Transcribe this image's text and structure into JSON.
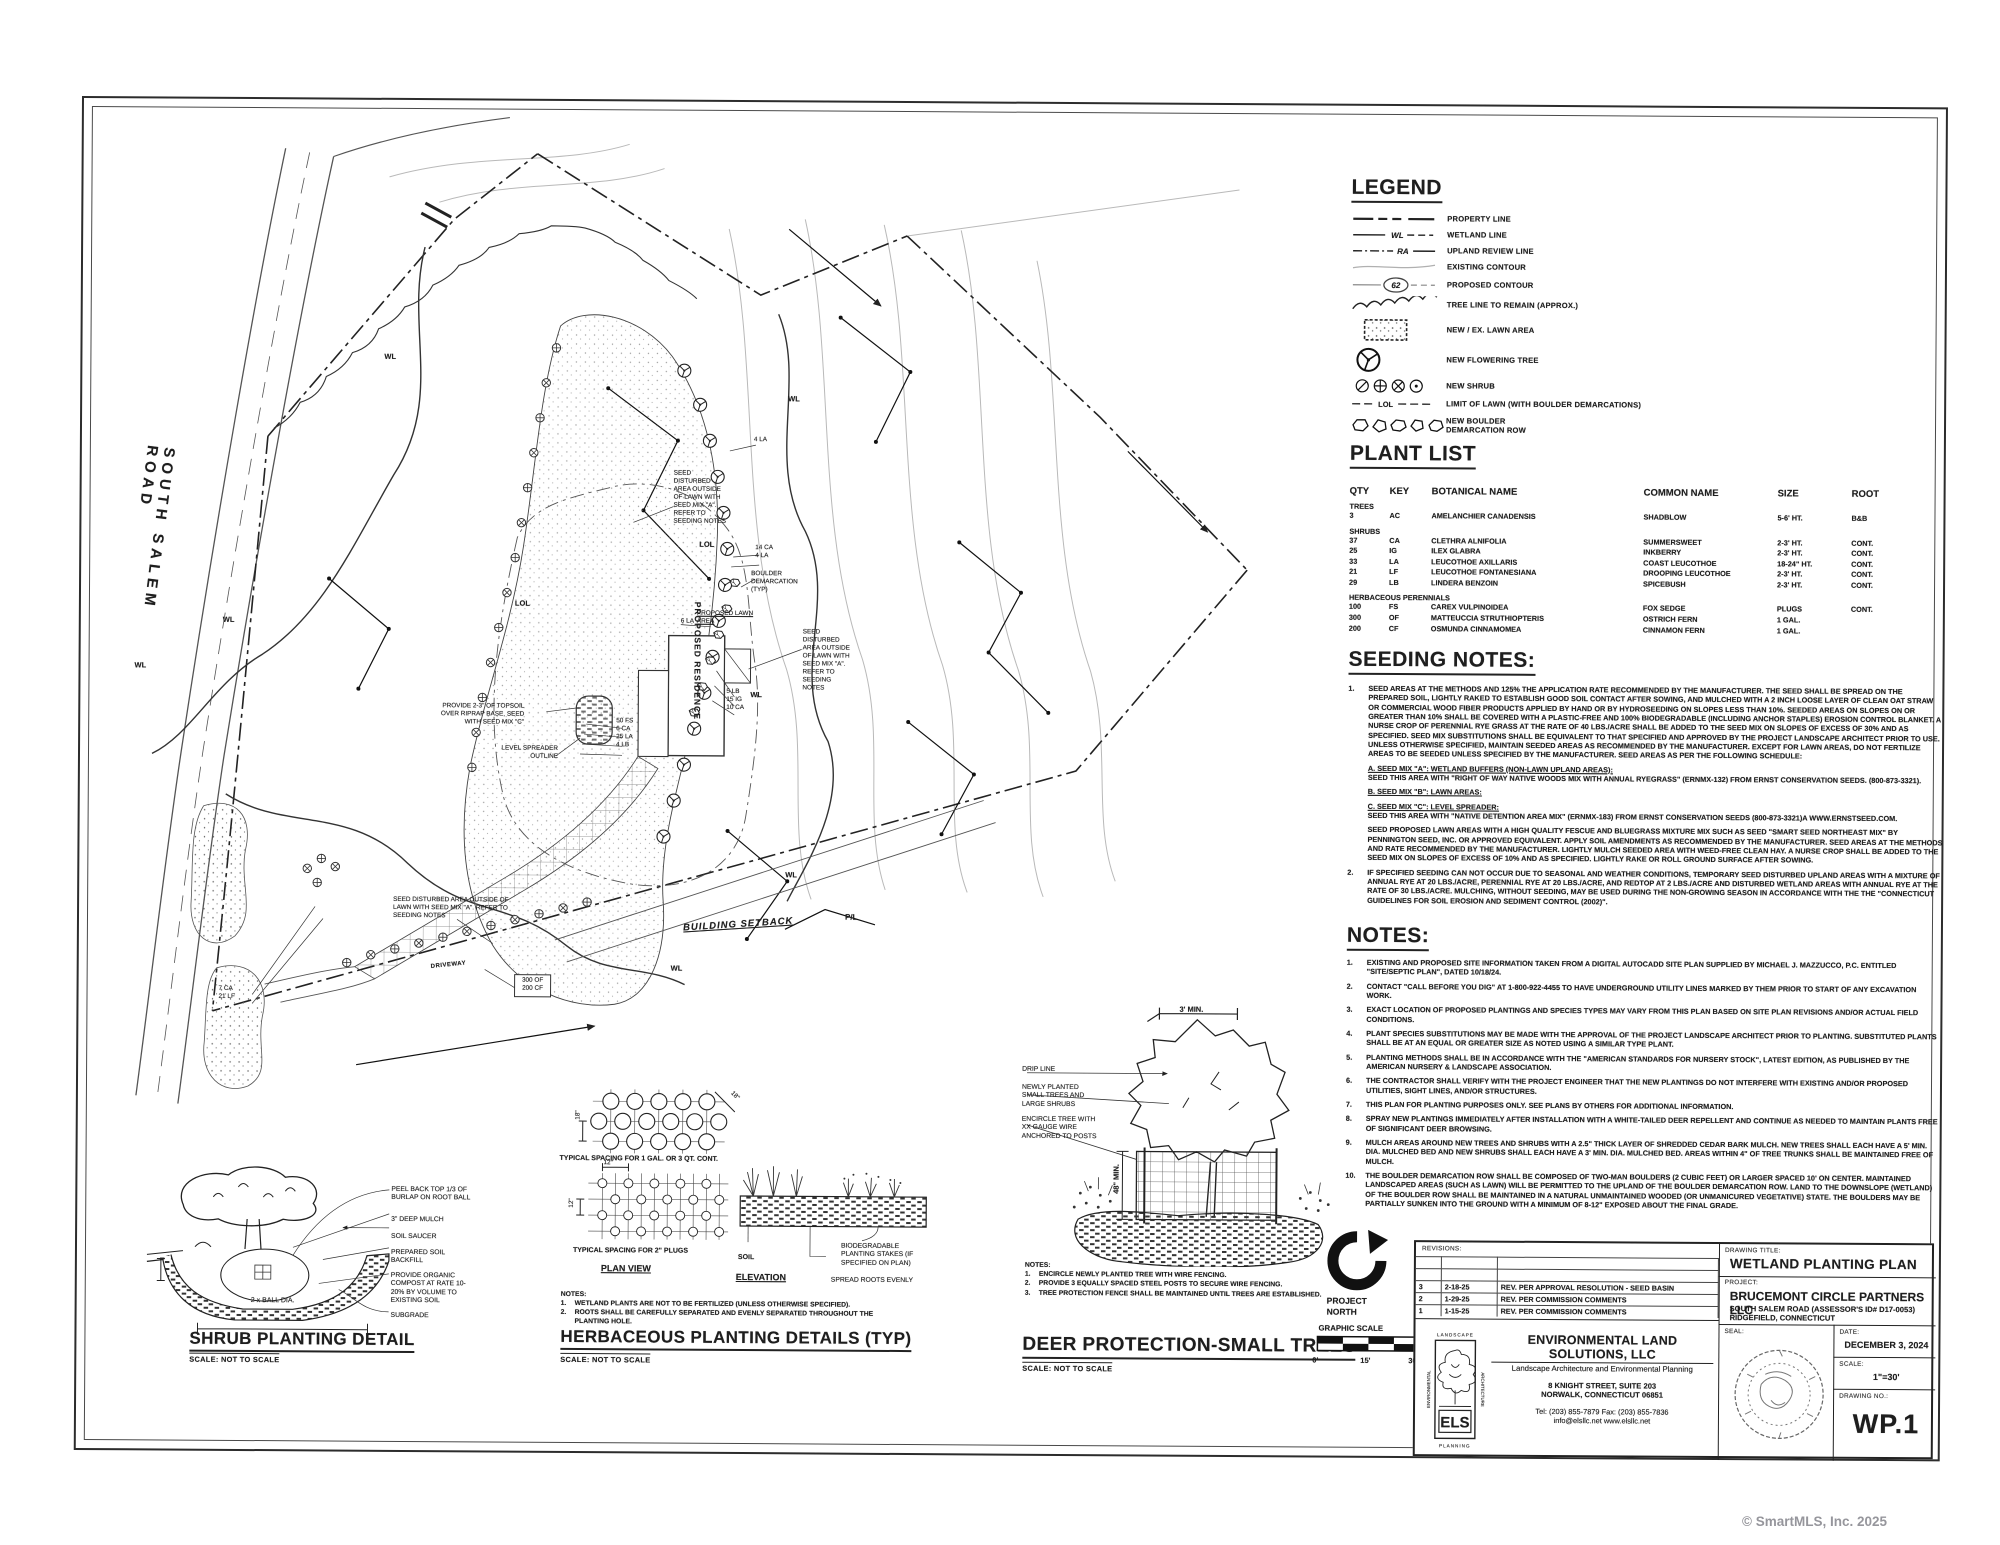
{
  "watermark": "© SmartMLS, Inc.  2025",
  "legend": {
    "title": "LEGEND",
    "items": [
      {
        "label": "PROPERTY LINE"
      },
      {
        "label": "WETLAND LINE",
        "tag": "WL"
      },
      {
        "label": "UPLAND REVIEW LINE",
        "tag": "RA"
      },
      {
        "label": "EXISTING CONTOUR"
      },
      {
        "label": "PROPOSED CONTOUR",
        "tag": "62"
      },
      {
        "label": "TREE LINE TO REMAIN (APPROX.)"
      },
      {
        "label": "NEW / EX. LAWN AREA"
      },
      {
        "label": "NEW FLOWERING TREE"
      },
      {
        "label": "NEW SHRUB"
      },
      {
        "label": "LIMIT OF LAWN (WITH BOULDER DEMARCATIONS)",
        "tag": "LOL"
      },
      {
        "label": "NEW BOULDER DEMARCATION ROW"
      }
    ]
  },
  "plant_list": {
    "title": "PLANT LIST",
    "headers": [
      "QTY",
      "KEY",
      "BOTANICAL NAME",
      "COMMON NAME",
      "SIZE",
      "ROOT"
    ],
    "groups": [
      {
        "name": "TREES",
        "rows": [
          [
            "3",
            "AC",
            "AMELANCHIER CANADENSIS",
            "SHADBLOW",
            "5-6' HT.",
            "B&B"
          ]
        ]
      },
      {
        "name": "SHRUBS",
        "rows": [
          [
            "37",
            "CA",
            "CLETHRA ALNIFOLIA",
            "SUMMERSWEET",
            "2-3' HT.",
            "CONT."
          ],
          [
            "25",
            "IG",
            "ILEX GLABRA",
            "INKBERRY",
            "2-3' HT.",
            "CONT."
          ],
          [
            "33",
            "LA",
            "LEUCOTHOE AXILLARIS",
            "COAST LEUCOTHOE",
            "18-24\" HT.",
            "CONT."
          ],
          [
            "21",
            "LF",
            "LEUCOTHOE FONTANESIANA",
            "DROOPING LEUCOTHOE",
            "2-3' HT.",
            "CONT."
          ],
          [
            "29",
            "LB",
            "LINDERA BENZOIN",
            "SPICEBUSH",
            "2-3' HT.",
            "CONT."
          ]
        ]
      },
      {
        "name": "HERBACEOUS PERENNIALS",
        "rows": [
          [
            "100",
            "FS",
            "CAREX VULPINOIDEA",
            "FOX SEDGE",
            "PLUGS",
            "CONT."
          ],
          [
            "300",
            "OF",
            "MATTEUCCIA STRUTHIOPTERIS",
            "OSTRICH FERN",
            "1 GAL.",
            ""
          ],
          [
            "200",
            "CF",
            "OSMUNDA CINNAMOMEA",
            "CINNAMON FERN",
            "1 GAL.",
            ""
          ]
        ]
      }
    ]
  },
  "seeding": {
    "title": "SEEDING NOTES:",
    "n1num": "1.",
    "n1": "SEED AREAS AT THE METHODS AND 125% THE APPLICATION RATE RECOMMENDED BY THE MANUFACTURER.  THE SEED SHALL BE SPREAD ON THE PREPARED SOIL, LIGHTLY RAKED TO ESTABLISH GOOD SOIL CONTACT AFTER SOWING, AND MULCHED WITH A 2 INCH LOOSE LAYER OF CLEAN OAT STRAW OR COMMERCIAL WOOD FIBER PRODUCTS APPLIED BY HAND OR BY HYDROSEEDING ON SLOPES LESS THAN 10%.  SEEDED AREAS ON SLOPES ON OR GREATER THAN 10% SHALL BE COVERED WITH A PLASTIC-FREE AND 100% BIODEGRADABLE (INCLUDING ANCHOR STAPLES) EROSION CONTROL BLANKET.  A NURSE CROP OF PERENNIAL RYE GRASS AT THE RATE OF 40 LBS./ACRE SHALL BE ADDED TO THE SEED MIX ON SLOPES OF EXCESS OF 30% AND AS SPECIFIED.  SEED MIX SUBSTITUTIONS SHALL BE EQUIVALENT TO THAT SPECIFIED AND APPROVED BY THE PROJECT LANDSCAPE ARCHITECT PRIOR TO USE.  UNLESS OTHERWISE SPECIFIED, MAINTAIN SEEDED AREAS AS RECOMMENDED BY THE MANUFACTURER.  EXCEPT FOR LAWN AREAS, DO NOT FERTILIZE AREAS TO BE SEEDED UNLESS SPECIFIED BY THE MANUFACTURER.  SEED AREAS AS PER THE FOLLOWING SCHEDULE:",
    "mix_a_head": "A. SEED MIX \"A\":  WETLAND BUFFERS (NON-LAWN UPLAND AREAS):",
    "mix_a_body": "SEED THIS AREA WITH \"RIGHT OF WAY NATIVE WOODS MIX WITH ANNUAL RYEGRASS\" (ERNMX-132) FROM ERNST CONSERVATION SEEDS. (800-873-3321).",
    "mix_b_head": "B. SEED MIX \"B\": LAWN AREAS:",
    "mix_c_head": "C. SEED MIX \"C\":  LEVEL SPREADER:",
    "mix_c_body": "SEED THIS AREA WITH \"NATIVE DETENTION AREA MIX\" (ERNMX-183) FROM ERNST CONSERVATION SEEDS (800-873-3321)A WWW.ERNSTSEED.COM.",
    "lawn_para": "SEED PROPOSED LAWN AREAS WITH A HIGH QUALITY FESCUE AND BLUEGRASS MIXTURE MIX SUCH AS SEED \"SMART SEED NORTHEAST MIX\" BY PENNINGTON SEED, INC. OR APPROVED EQUIVALENT.  APPLY SOIL AMENDMENTS AS RECOMMENDED BY THE MANUFACTURER.  SEED AREAS AT THE METHODS AND RATE RECOMMENDED BY THE MANUFACTURER.  LIGHTLY MULCH SEEDED AREA WITH WEED-FREE CLEAN HAY.  A NURSE CROP SHALL BE ADDED TO THE SEED MIX ON SLOPES OF EXCESS OF 10% AND AS SPECIFIED.  LIGHTLY RAKE OR ROLL GROUND SURFACE AFTER SOWING.",
    "n2num": "2.",
    "n2": "IF SPECIFIED SEEDING CAN NOT OCCUR DUE TO SEASONAL AND WEATHER CONDITIONS, TEMPORARY SEED DISTURBED UPLAND AREAS WITH A MIXTURE OF ANNUAL RYE AT 20 LBS./ACRE, PERENNIAL RYE AT 20 LBS./ACRE, AND REDTOP AT 2 LBS./ACRE AND DISTURBED WETLAND AREAS WITH ANNUAL RYE AT THE RATE OF 30 LBS./ACRE.  MULCHING, WITHOUT SEEDING, MAY BE USED DURING THE NON-GROWING SEASON IN ACCORDANCE WITH THE THE \"CONNECTICUT GUIDELINES FOR SOIL EROSION AND SEDIMENT CONTROL (2002)\"."
  },
  "notes": {
    "title": "NOTES:",
    "items": [
      {
        "n": "1.",
        "t": "EXISTING AND PROPOSED SITE INFORMATION TAKEN FROM A DIGITAL AUTOCADD SITE PLAN SUPPLIED BY MICHAEL J. MAZZUCCO, P.C.  ENTITLED \"SITE/SEPTIC PLAN\", DATED 10/18/24."
      },
      {
        "n": "2.",
        "t": "CONTACT \"CALL BEFORE YOU DIG\" AT 1-800-922-4455 TO HAVE UNDERGROUND UTILITY LINES MARKED BY THEM PRIOR TO START OF ANY EXCAVATION WORK."
      },
      {
        "n": "3.",
        "t": "EXACT LOCATION OF PROPOSED PLANTINGS AND SPECIES TYPES MAY VARY FROM THIS PLAN BASED ON SITE PLAN REVISIONS AND/OR ACTUAL FIELD CONDITIONS."
      },
      {
        "n": "4.",
        "t": "PLANT SPECIES SUBSTITUTIONS MAY BE MADE WITH THE APPROVAL OF THE PROJECT LANDSCAPE ARCHITECT PRIOR TO PLANTING.  SUBSTITUTED PLANTS SHALL BE AT AN EQUAL OR GREATER SIZE AS NOTED USING A SIMILAR TYPE PLANT."
      },
      {
        "n": "5.",
        "t": "PLANTING METHODS SHALL BE IN ACCORDANCE WITH THE \"AMERICAN STANDARDS FOR NURSERY STOCK\", LATEST EDITION, AS PUBLISHED BY THE AMERICAN NURSERY & LANDSCAPE ASSOCIATION."
      },
      {
        "n": "6.",
        "t": "THE CONTRACTOR SHALL VERIFY WITH THE PROJECT ENGINEER THAT THE NEW PLANTINGS DO NOT INTERFERE WITH EXISTING AND/OR PROPOSED UTILITIES, SIGHT LINES, AND/OR STRUCTURES."
      },
      {
        "n": "7.",
        "t": "THIS PLAN FOR PLANTING PURPOSES ONLY.  SEE PLANS BY OTHERS FOR ADDITIONAL INFORMATION."
      },
      {
        "n": "8.",
        "t": "SPRAY NEW PLANTINGS IMMEDIATELY AFTER INSTALLATION WITH A WHITE-TAILED DEER REPELLENT AND CONTINUE AS NEEDED TO MAINTAIN PLANTS FREE OF SIGNIFICANT DEER BROWSING."
      },
      {
        "n": "9.",
        "t": "MULCH AREAS AROUND NEW TREES AND SHRUBS WITH A 2.5\" THICK LAYER OF SHREDDED CEDAR BARK MULCH.  NEW TREES SHALL EACH HAVE A 5' MIN. DIA. MULCHED BED AND NEW SHRUBS SHALL EACH HAVE A 3' MIN. DIA. MULCHED BED.  AREAS WITHIN 4\" OF TREE TRUNKS SHALL BE MAINTAINED FREE OF MULCH."
      },
      {
        "n": "10.",
        "t": "THE BOULDER DEMARCATION ROW SHALL BE COMPOSED OF TWO-MAN BOULDERS (2 CUBIC FEET) OR LARGER SPACED 10' ON CENTER.  MAINTAINED LANDSCAPED AREAS (SUCH AS LAWN) WILL BE PERMITTED TO THE UPLAND OF THE BOULDER DEMARCATION ROW.  LAND TO THE DOWNSLOPE (WETLAND) OF THE BOULDER ROW SHALL BE MAINTAINED IN A NATURAL UNMAINTAINED WOODED (OR UNMANICURED VEGETATIVE) STATE.  THE BOULDERS MAY BE PARTIALLY SUNKEN INTO THE GROUND WITH A MINIMUM OF 8-12\" EXPOSED ABOUT THE FINAL GRADE."
      }
    ]
  },
  "site_plan": {
    "road_name": "SOUTH  SALEM  ROAD",
    "residence": "PROPOSED RESIDENCE",
    "lawn_label": "PROPOSED LAWN AREA",
    "seed_note": "SEED DISTURBED AREA OUTSIDE OF LAWN WITH SEED MIX \"A\". REFER TO SEEDING NOTES",
    "boulder_typ": "BOULDER DEMARCATION (TYP)",
    "building_setback": "BUILDING SETBACK",
    "driveway_label": "DRIVEWAY",
    "level_spreader": "LEVEL SPREADER OUTLINE",
    "topsoil_note": "PROVIDE 2-3\" OF TOPSOIL OVER RIPRAP BASE, SEED WITH SEED MIX \"C\"",
    "wl": "WL",
    "lol": "LOL",
    "pl": "P/L",
    "c6la": "6 LA",
    "c4la": "4 LA",
    "c14ca": "14 CA",
    "c4la2": "4 LA",
    "g1": [
      "50 FS",
      "6 CA",
      "25 LA",
      "4 LB"
    ],
    "g2": [
      "5 LB",
      "15 IG",
      "10 CA"
    ],
    "g3": [
      "7 CA",
      "21 LF"
    ],
    "box": [
      "300 OF",
      "200 CF"
    ]
  },
  "details": {
    "shrub": {
      "title": "SHRUB PLANTING DETAIL",
      "scale": "SCALE:  NOT TO SCALE",
      "dim": "2 x BALL DIA.",
      "callouts": [
        "PEEL BACK TOP 1/3 OF BURLAP ON ROOT BALL",
        "3\" DEEP MULCH",
        "SOIL SAUCER",
        "PREPARED SOIL BACKFILL",
        "PROVIDE ORGANIC COMPOST AT RATE 10-20% BY VOLUME TO EXISTING SOIL",
        "SUBGRADE"
      ]
    },
    "herbaceous": {
      "title": "HERBACEOUS PLANTING DETAILS (TYP)",
      "scale": "SCALE:  NOT TO SCALE",
      "cap1": "TYPICAL SPACING FOR 1 GAL. OR 3 QT. CONT.",
      "cap2": "TYPICAL SPACING FOR 2\" PLUGS",
      "plan_view": "PLAN VIEW",
      "elevation": "ELEVATION",
      "dim18": "18\"",
      "dim12": "12\"",
      "soil": "SOIL",
      "stakes": "BIODEGRADABLE PLANTING STAKES (IF SPECIFIED ON PLAN)",
      "roots": "SPREAD ROOTS EVENLY",
      "notes_label": "NOTES:",
      "notes": [
        {
          "n": "1.",
          "t": "WETLAND PLANTS ARE NOT TO BE FERTILIZED (UNLESS OTHERWISE SPECIFIED)."
        },
        {
          "n": "2.",
          "t": "ROOTS SHALL BE CAREFULLY SEPARATED AND EVENLY SEPARATED THROUGHOUT THE PLANTING HOLE."
        }
      ]
    },
    "deer": {
      "title": "DEER PROTECTION-SMALL TREES",
      "scale": "SCALE: NOT TO SCALE",
      "dim_top": "3' MIN.",
      "dim_side": "48\" MIN.",
      "callouts": [
        "DRIP LINE",
        "NEWLY PLANTED SMALL TREES AND LARGE SHRUBS",
        "ENCIRCLE TREE WITH XX GAUGE WIRE ANCHORED TO POSTS"
      ],
      "notes_label": "NOTES:",
      "notes": [
        {
          "n": "1.",
          "t": "ENCIRCLE NEWLY PLANTED TREE WITH WIRE FENCING."
        },
        {
          "n": "2.",
          "t": "PROVIDE 3 EQUALLY SPACED STEEL POSTS TO SECURE WIRE FENCING."
        },
        {
          "n": "3.",
          "t": "TREE PROTECTION FENCE SHALL BE MAINTAINED UNTIL TREES ARE ESTABLISHED."
        }
      ]
    },
    "north": {
      "l1": "PROJECT",
      "l2": "NORTH"
    },
    "scalebar": {
      "label": "GRAPHIC SCALE",
      "t0": "0'",
      "t15": "15'",
      "t30": "30'"
    }
  },
  "title_block": {
    "revisions_label": "REVISIONS:",
    "revisions": [
      {
        "no": "3",
        "date": "2-18-25",
        "desc": "REV. PER APPROVAL RESOLUTION - SEED BASIN"
      },
      {
        "no": "2",
        "date": "1-29-25",
        "desc": "REV. PER COMMISSION COMMENTS"
      },
      {
        "no": "1",
        "date": "1-15-25",
        "desc": "REV. PER COMMISSION COMMENTS"
      }
    ],
    "drawing_title_label": "DRAWING TITLE:",
    "drawing_title": "WETLAND PLANTING PLAN",
    "project_label": "PROJECT:",
    "project_name": "BRUCEMONT CIRCLE PARTNERS LLC",
    "project_addr1": "SOUTH SALEM ROAD (ASSESSOR'S ID# D17-0053)",
    "project_addr2": "RIDGEFIELD, CONNECTICUT",
    "seal_label": "SEAL:",
    "date_label": "DATE:",
    "date": "DECEMBER 3, 2024",
    "scale_label": "SCALE:",
    "scale": "1\"=30'",
    "drawing_no_label": "DRAWING NO.:",
    "drawing_no": "WP.1",
    "firm": {
      "name": "ENVIRONMENTAL LAND SOLUTIONS, LLC",
      "tagline": "Landscape  Architecture  and  Environmental  Planning",
      "addr1": "8 KNIGHT STREET, SUITE 203",
      "addr2": "NORWALK, CONNECTICUT 06851",
      "phone": "Tel: (203) 855-7879    Fax: (203) 855-7836",
      "web": "info@elsllc.net    www.elsllc.net",
      "logo_text": "ELS",
      "logo_top": "LANDSCAPE",
      "logo_left": "ENVIRONMENTAL",
      "logo_right": "ARCHITECTURE",
      "logo_bottom": "PLANNING"
    }
  }
}
